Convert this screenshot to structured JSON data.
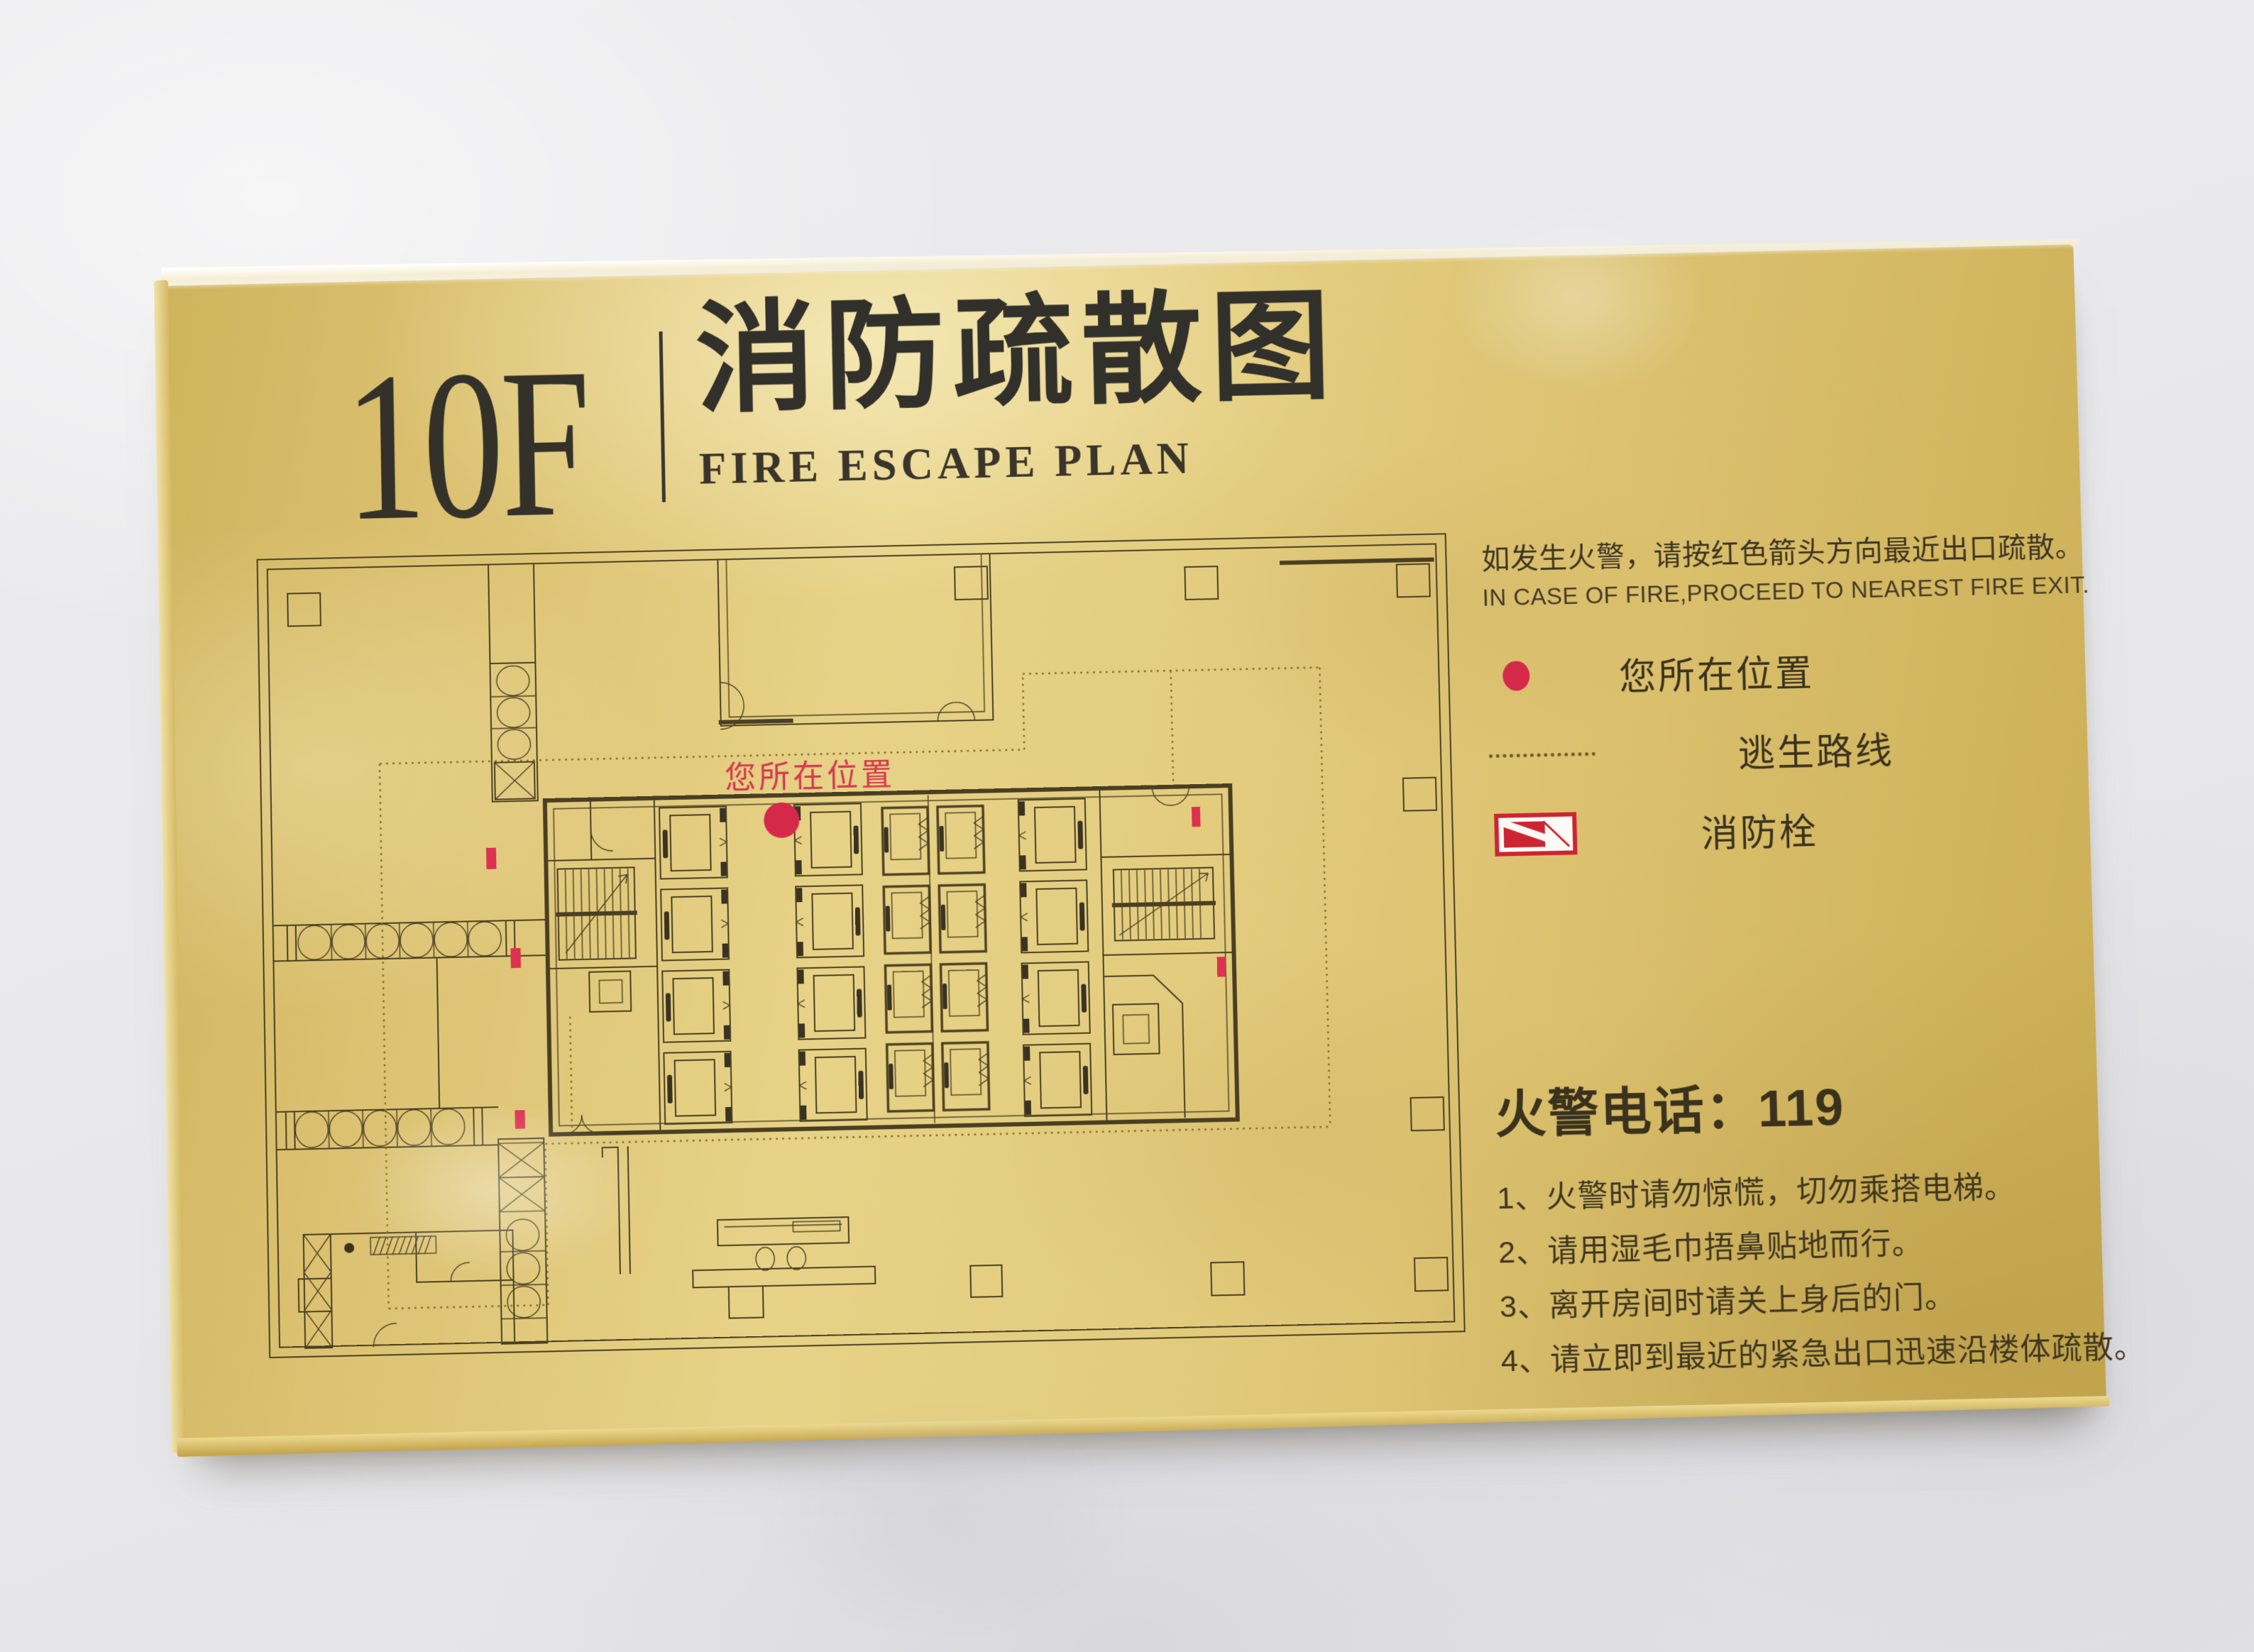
{
  "header": {
    "floor_label": "10F",
    "title_cn": "消防疏散图",
    "title_en": "FIRE ESCAPE PLAN"
  },
  "instructions": {
    "cn": "如发生火警，请按红色箭头方向最近出口疏散。",
    "en": "IN CASE OF FIRE,PROCEED TO NEAREST FIRE EXIT."
  },
  "legend": {
    "items": [
      {
        "icon": "red-dot",
        "label": "您所在位置"
      },
      {
        "icon": "dotted-line",
        "label": "逃生路线"
      },
      {
        "icon": "fire-hydrant",
        "label": "消防栓"
      }
    ]
  },
  "map": {
    "you_are_here_label": "您所在位置"
  },
  "emergency": {
    "phone_title": "火警电话：119",
    "items": [
      "1、火警时请勿惊慌，切勿乘搭电梯。",
      "2、请用湿毛巾捂鼻贴地而行。",
      "3、离开房间时请关上身后的门。",
      "4、请立即到最近的紧急出口迅速沿楼体疏散。"
    ]
  },
  "colors": {
    "plaque_gold": "#dcc370",
    "plan_line": "#4a3f22",
    "route_dotted": "#8a7428",
    "accent_red": "#d5294a",
    "hydrant_red": "#cd2433",
    "ink": "#3a321c"
  }
}
